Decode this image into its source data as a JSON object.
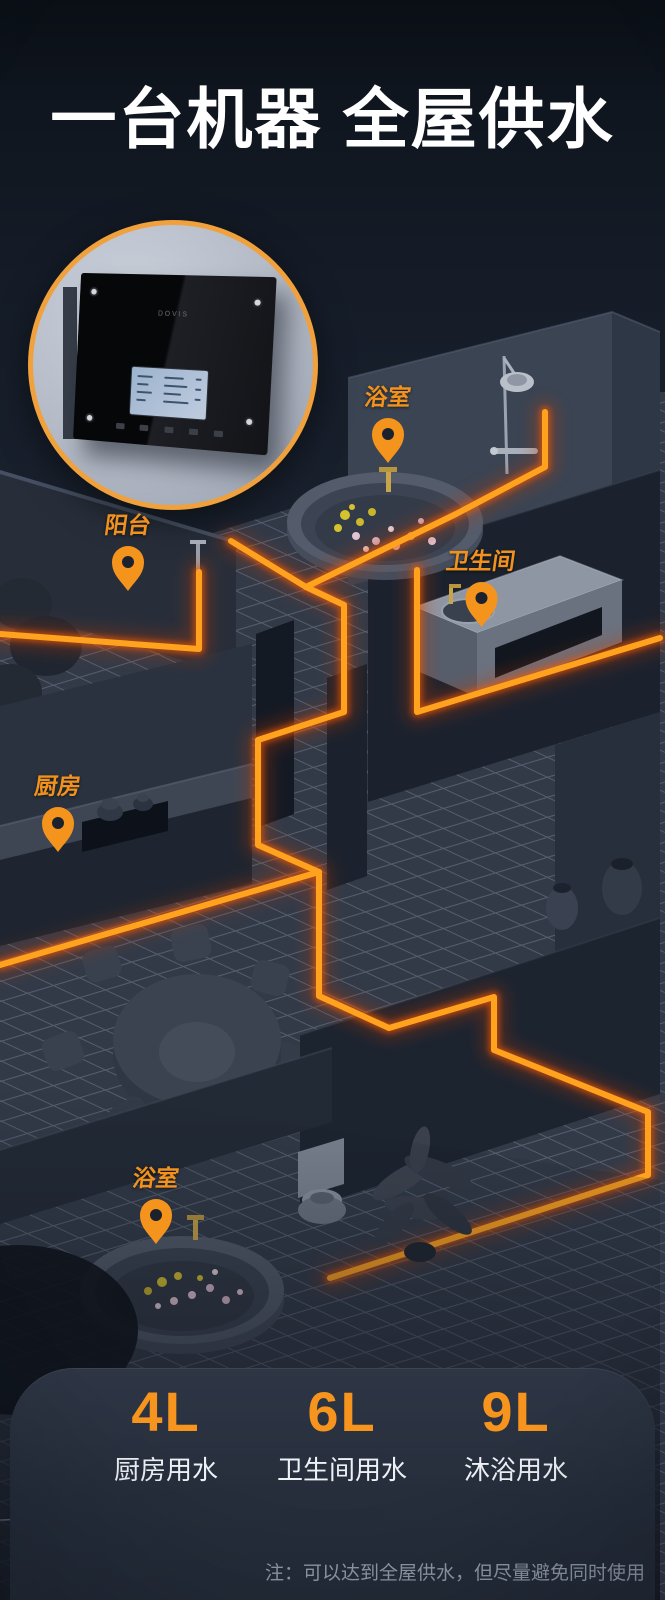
{
  "header": {
    "title": "一台机器 全屋供水"
  },
  "device_inset": {
    "logo_text": "DOVIS"
  },
  "pins": [
    {
      "id": "bathroom-top",
      "label": "浴室"
    },
    {
      "id": "balcony",
      "label": "阳台"
    },
    {
      "id": "washroom",
      "label": "卫生间"
    },
    {
      "id": "kitchen",
      "label": "厨房"
    },
    {
      "id": "bathroom-bottom",
      "label": "浴室"
    }
  ],
  "stats": [
    {
      "value": "4L",
      "label": "厨房用水"
    },
    {
      "value": "6L",
      "label": "卫生间用水"
    },
    {
      "value": "9L",
      "label": "沐浴用水"
    }
  ],
  "footnote": "注：可以达到全屋供水，但尽量避免同时使用",
  "colors": {
    "accent_orange": "#f7941d",
    "pipe_core": "#ffa31f",
    "pipe_glow": "#ff5f00",
    "background_navy": "#1d2532",
    "panel": "#2a3240",
    "title_text": "#ffffff"
  }
}
